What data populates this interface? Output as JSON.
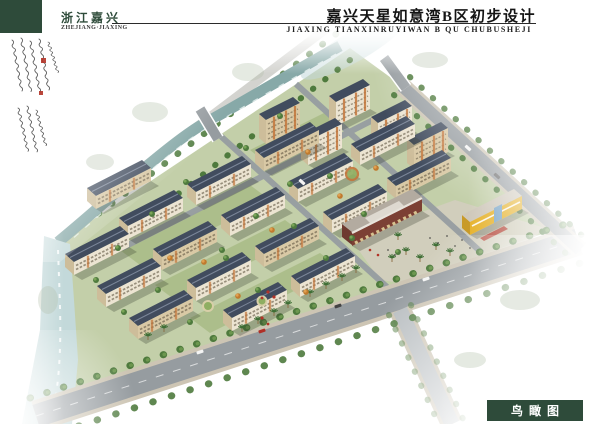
{
  "header": {
    "region_cn": "浙江嘉兴",
    "region_en": "ZHEJIANG·JIAXING",
    "title_cn": "嘉兴天星如意湾B区初步设计",
    "title_en": "JIAXING TIANXINRUYIWAN B QU CHUBUSHEJI"
  },
  "footer": {
    "view_label": "鸟瞰图"
  },
  "palette": {
    "paper": "#ffffff",
    "brand_green": "#2e4b3a",
    "seal_red": "#b23327",
    "water_canal": "#87a9a8",
    "water_river": "#c3d9da",
    "road_gray": "#969ca0",
    "sidewalk": "#cdc5b4",
    "site_ground": "#c3cfa9",
    "lawn_dark": "#8aa65e",
    "roof_dark": "#414c5e",
    "roof_ridge": "#7b8699",
    "facade_cream": "#ece4d2",
    "facade_tan": "#d9c9a5",
    "facade_end": "#cdbd9a",
    "accent_orange": "#c3763b",
    "tree_green": "#4e7a3d",
    "tree_light": "#79a457",
    "palm_green": "#3e6e35",
    "commercial_red": "#7c4034",
    "commercial_roof": "#b3aba0",
    "kindergarten_yellow": "#e6b32e",
    "glass_blue": "#7fa8c9"
  }
}
